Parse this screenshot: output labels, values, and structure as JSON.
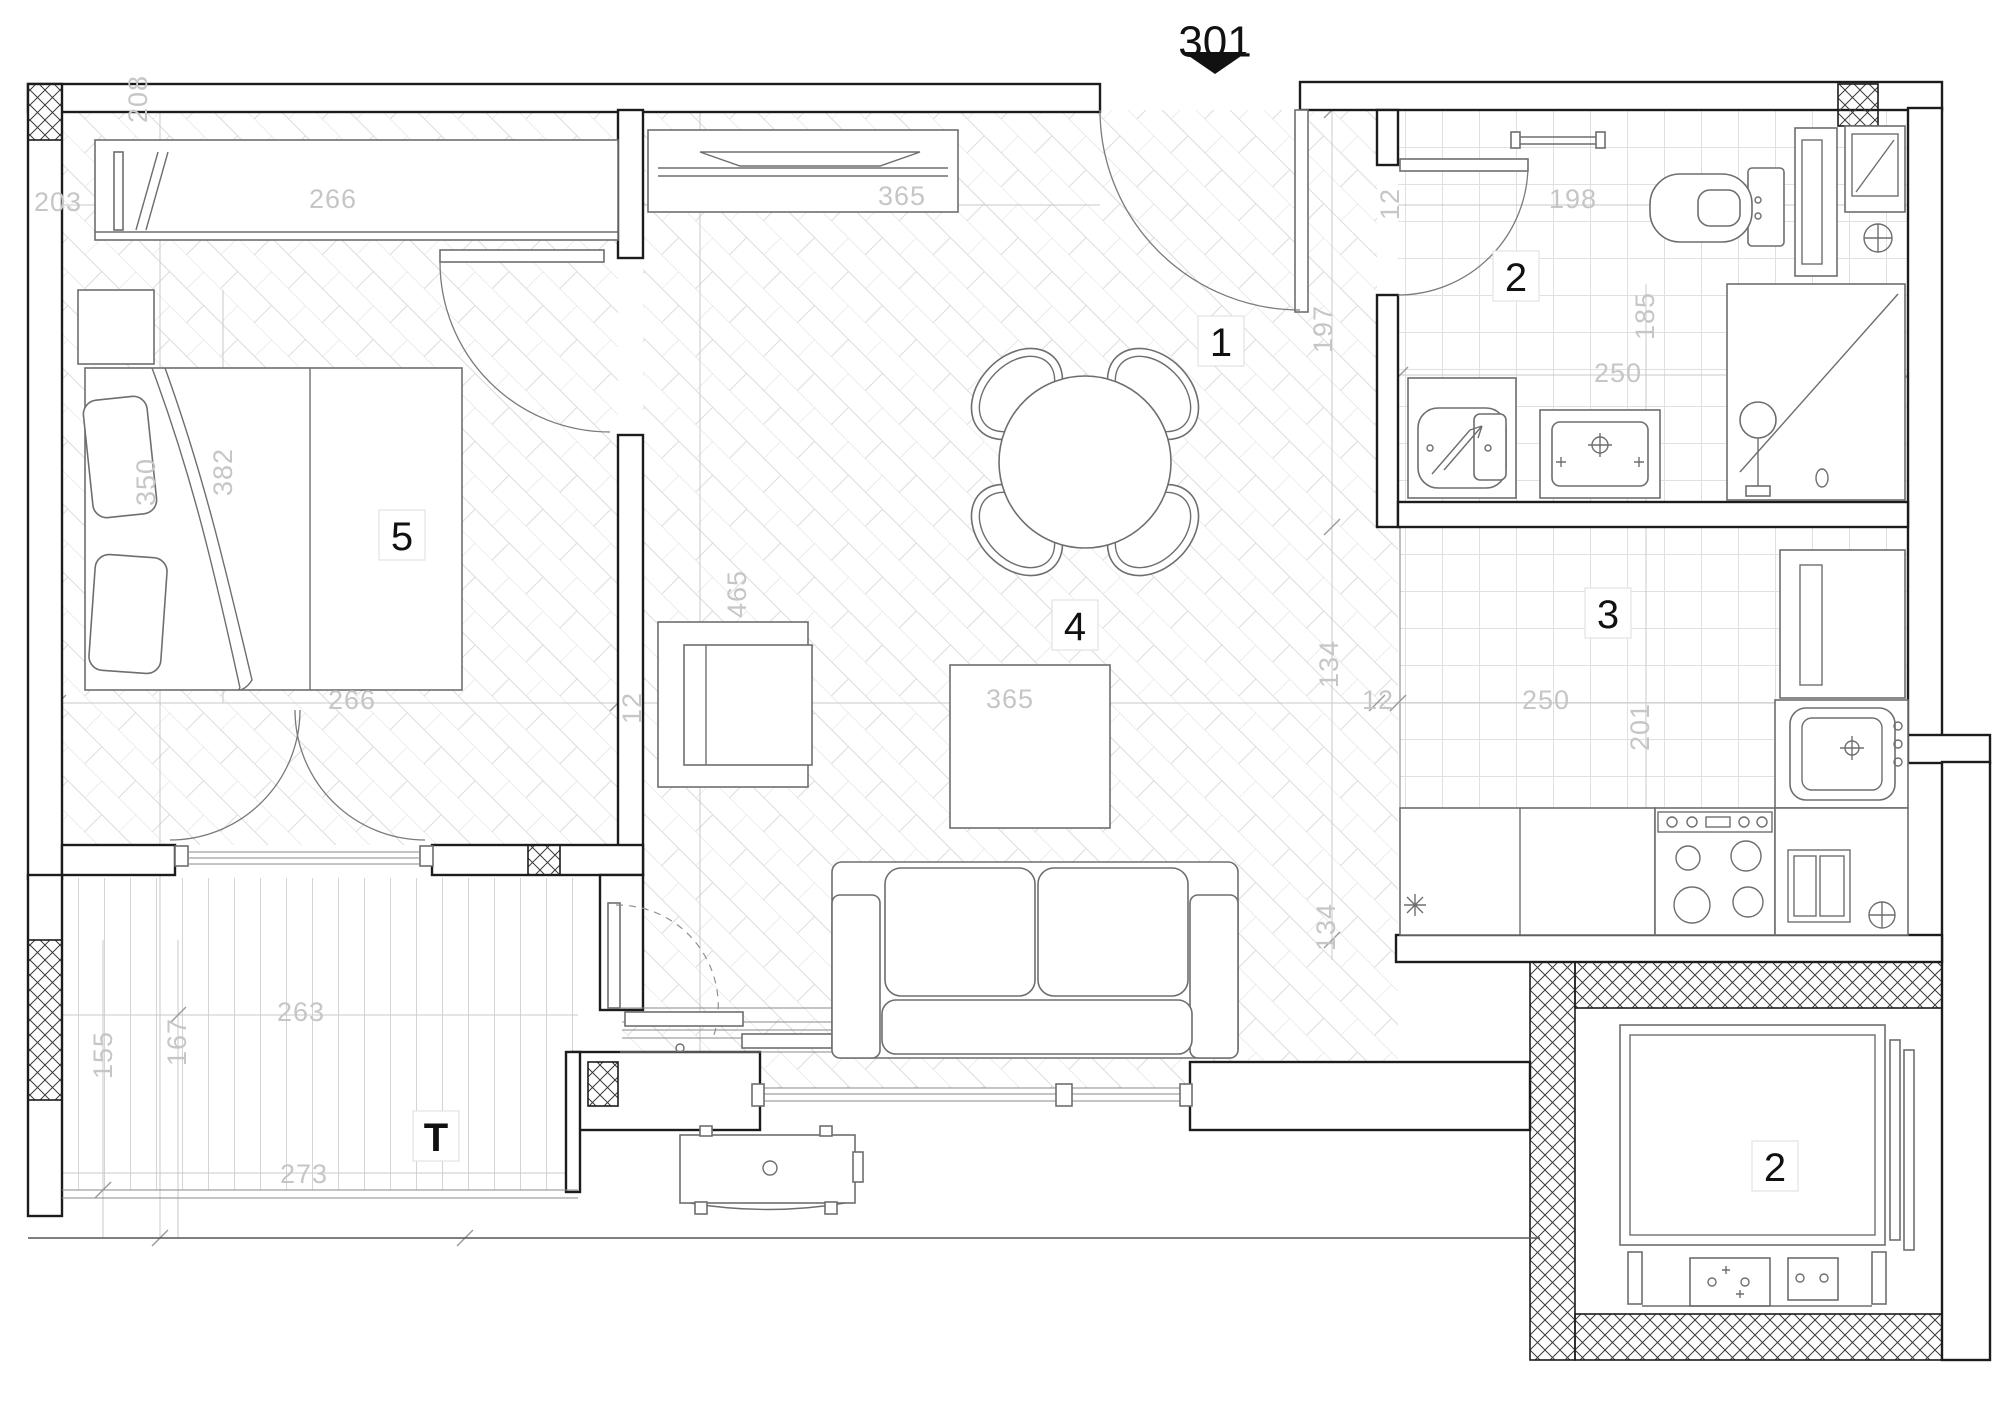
{
  "apartment_number": "301",
  "rooms": [
    {
      "id": "hallway",
      "label": "1"
    },
    {
      "id": "bathroom",
      "label": "2"
    },
    {
      "id": "kitchen",
      "label": "3"
    },
    {
      "id": "living-dining",
      "label": "4"
    },
    {
      "id": "bedroom",
      "label": "5"
    },
    {
      "id": "terrace",
      "label": "T"
    },
    {
      "id": "elevator",
      "label": "2"
    }
  ],
  "dimensions_cm": [
    "203",
    "208",
    "266",
    "365",
    "12",
    "198",
    "197",
    "185",
    "250",
    "350",
    "382",
    "465",
    "266",
    "12",
    "365",
    "134",
    "12",
    "250",
    "201",
    "134",
    "155",
    "167",
    "263",
    "273"
  ],
  "colors": {
    "wall_line": "#1c1c1c",
    "furniture_line": "#6e6e6e",
    "dimension_text": "#c6c6c6",
    "floor_pattern": "#dcdcdc",
    "background": "#ffffff"
  }
}
